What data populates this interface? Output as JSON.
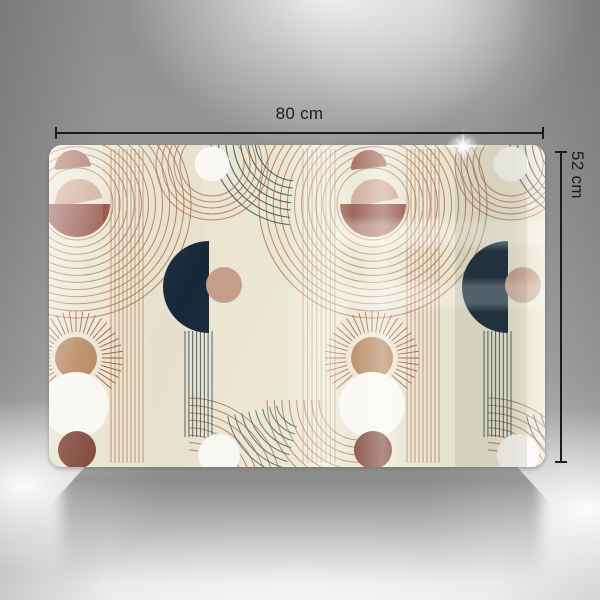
{
  "dimensions": {
    "width_label": "80 cm",
    "height_label": "52 cm"
  },
  "icons": {
    "sparkle": "sparkle-glint-icon"
  },
  "palette": {
    "cream": "#eae5d1",
    "cream_band": "#e2dcc6",
    "rust": "#8a4738",
    "rose": "#9c5a4c",
    "pink": "#c9a189",
    "tan": "#c49c88",
    "navy": "#16273a",
    "teal": "#2f5a5c",
    "teal_dark": "#24454e",
    "line_brown": "#a5653f",
    "line_rust": "#a2543e",
    "ray": "#9b4f35",
    "white_shape": "#f8f7f2",
    "brown_circle": "#7f4537",
    "sun_center": "#b28055",
    "dim_line": "#1c1c1a"
  }
}
